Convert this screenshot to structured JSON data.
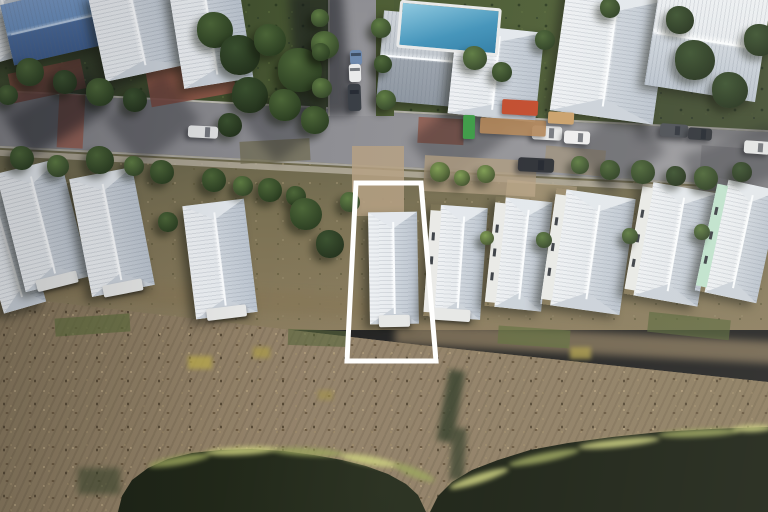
{
  "meta": {
    "image_type": "aerial-drone-photo",
    "description": "Oblique aerial photograph of a coastal neighborhood: a street with parked cars and construction items at top, a row of white metal hip-roof cottages in the middle, brown marsh grass below, dark ponds at the bottom, and a white boundary outline highlighting one lot with a house.",
    "width": 768,
    "height": 512
  },
  "palette": {
    "roof_light": "#eef1f4",
    "roof_dark": "#bac3ce",
    "ridge": "#f8fafc",
    "roof_blue_light": "#7b9cc9",
    "roof_blue_dark": "#3d5c8c",
    "asphalt": "#8e8e93",
    "sidewalk": "#b3ac9c",
    "brick": "#94584a",
    "tree_dark": "#24331d",
    "tree_light": "#7e9c52",
    "ground_green": "#45532f",
    "dirt": "#7c7254",
    "marsh": "#8d7c60",
    "water": "#20261a",
    "shore_grass": "#9aa45c",
    "shore_grass_bright": "#ccd07e",
    "pool": "#4293ba",
    "mint_wall": "#bfe2cd",
    "white_wall": "#e9eae7",
    "outline": "#ffffff",
    "dumpster": "#c14a2c",
    "porta_potty": "#3c9a46"
  },
  "highlight": {
    "name": "property-boundary-outline",
    "points": "356,183 421,183 436,361 347,361",
    "stroke": "#ffffff",
    "stroke_width": 5
  },
  "scene": {
    "houses": [
      {
        "x": -14,
        "y": 186,
        "w": 44,
        "h": 124,
        "r": -16
      },
      {
        "x": 10,
        "y": 164,
        "w": 66,
        "h": 122,
        "r": -14,
        "porch": true
      },
      {
        "x": 80,
        "y": 172,
        "w": 64,
        "h": 120,
        "r": -11,
        "porch": true
      },
      {
        "x": 189,
        "y": 202,
        "w": 62,
        "h": 114,
        "r": -7,
        "porch": true
      },
      {
        "x": 369,
        "y": 212,
        "w": 49,
        "h": 112,
        "r": -1,
        "porch": true,
        "name": "highlighted-house"
      },
      {
        "x": 427,
        "y": 206,
        "w": 57,
        "h": 112,
        "r": 4,
        "wall": "white",
        "porch": true
      },
      {
        "x": 490,
        "y": 199,
        "w": 57,
        "h": 110,
        "r": 6,
        "wall": "white"
      },
      {
        "x": 548,
        "y": 193,
        "w": 80,
        "h": 117,
        "r": 8,
        "wall": "white"
      },
      {
        "x": 633,
        "y": 186,
        "w": 75,
        "h": 115,
        "r": 10,
        "wall": "white"
      },
      {
        "x": 706,
        "y": 183,
        "w": 63,
        "h": 115,
        "r": 12,
        "wall": "mint"
      }
    ],
    "top_buildings": [
      {
        "x": -14,
        "y": -8,
        "w": 46,
        "h": 66,
        "r": -16,
        "ridge": "v"
      },
      {
        "x": 6,
        "y": -6,
        "w": 92,
        "h": 62,
        "r": -13,
        "ridge": "h",
        "roof": "blue"
      },
      {
        "x": 96,
        "y": -14,
        "w": 84,
        "h": 88,
        "r": -12,
        "ridge": "v"
      },
      {
        "x": 176,
        "y": -16,
        "w": 70,
        "h": 100,
        "r": -9,
        "ridge": "v"
      },
      {
        "x": 380,
        "y": 14,
        "w": 86,
        "h": 90,
        "r": 5,
        "ridge": "h",
        "roof": "gray"
      },
      {
        "x": 452,
        "y": 28,
        "w": 88,
        "h": 90,
        "r": 6,
        "ridge": "v"
      },
      {
        "x": 558,
        "y": -8,
        "w": 104,
        "h": 126,
        "r": 8,
        "ridge": "v"
      },
      {
        "x": 652,
        "y": -12,
        "w": 112,
        "h": 106,
        "r": 9,
        "ridge": "h"
      }
    ],
    "pool": {
      "x": 398,
      "y": 4,
      "w": 96,
      "h": 42,
      "r": 5
    },
    "cars": [
      {
        "x": 350,
        "y": 50,
        "w": 12,
        "h": 15,
        "r": -2,
        "c": "#6d89ae"
      },
      {
        "x": 349,
        "y": 64,
        "w": 12,
        "h": 18,
        "r": -2,
        "c": "#e9eaeb"
      },
      {
        "x": 348,
        "y": 84,
        "w": 13,
        "h": 27,
        "r": -2,
        "c": "#383d44"
      },
      {
        "x": 188,
        "y": 126,
        "w": 30,
        "h": 12,
        "r": 3,
        "c": "#e2e3e4"
      },
      {
        "x": 532,
        "y": 126,
        "w": 30,
        "h": 14,
        "r": 3,
        "c": "#e6e7e8"
      },
      {
        "x": 564,
        "y": 131,
        "w": 26,
        "h": 13,
        "r": 3,
        "c": "#eeeeee"
      },
      {
        "x": 518,
        "y": 158,
        "w": 36,
        "h": 14,
        "r": 3,
        "c": "#2b2e34"
      },
      {
        "x": 660,
        "y": 124,
        "w": 28,
        "h": 13,
        "r": 4,
        "c": "#4a4e54"
      },
      {
        "x": 688,
        "y": 128,
        "w": 24,
        "h": 12,
        "r": 4,
        "c": "#2f3339"
      },
      {
        "x": 744,
        "y": 141,
        "w": 26,
        "h": 13,
        "r": 4,
        "c": "#e3e4e5"
      }
    ],
    "construction": [
      {
        "x": 502,
        "y": 100,
        "w": 36,
        "h": 15,
        "r": 3,
        "c": "#c14a2c",
        "name": "red-dumpster"
      },
      {
        "x": 463,
        "y": 115,
        "w": 12,
        "h": 24,
        "r": 1,
        "c": "#3c9a46",
        "name": "porta-potty"
      },
      {
        "x": 480,
        "y": 119,
        "w": 66,
        "h": 16,
        "r": 3,
        "c": "#b08355",
        "o": 0.9,
        "name": "lumber-stack"
      },
      {
        "x": 548,
        "y": 112,
        "w": 26,
        "h": 12,
        "r": 3,
        "c": "#caa06a",
        "name": "lumber-stack"
      }
    ],
    "shadows": [
      {
        "x": 115,
        "y": 90,
        "w": 75,
        "h": 60,
        "r": -38
      },
      {
        "x": 252,
        "y": 94,
        "w": 62,
        "h": 56,
        "r": -38
      },
      {
        "x": 418,
        "y": 108,
        "w": 85,
        "h": 58,
        "r": -38
      },
      {
        "x": 582,
        "y": 118,
        "w": 72,
        "h": 62,
        "r": -38
      },
      {
        "x": 12,
        "y": 92,
        "w": 95,
        "h": 45,
        "r": -30
      },
      {
        "x": 0,
        "y": 58,
        "w": 150,
        "h": 62,
        "r": -35
      },
      {
        "x": 688,
        "y": 138,
        "w": 95,
        "h": 52,
        "r": -20
      },
      {
        "x": 636,
        "y": 25,
        "w": 140,
        "h": 115,
        "r": 0,
        "o": 0.28
      },
      {
        "x": 293,
        "y": -8,
        "w": 54,
        "h": 125,
        "r": -4,
        "o": 0.55
      }
    ],
    "patches": [
      {
        "x": 10,
        "y": 66,
        "w": 74,
        "h": 30,
        "r": -12,
        "c": "#7b493d",
        "o": 0.85
      },
      {
        "x": 148,
        "y": 64,
        "w": 86,
        "h": 36,
        "r": -10,
        "c": "#96594b",
        "o": 0.9
      },
      {
        "x": 418,
        "y": 118,
        "w": 46,
        "h": 26,
        "r": 3,
        "c": "#8e5546",
        "o": 0.8
      },
      {
        "x": 700,
        "y": 148,
        "w": 80,
        "h": 45,
        "r": 4,
        "c": "#85858a",
        "o": 1
      },
      {
        "x": 545,
        "y": 148,
        "w": 60,
        "h": 26,
        "r": 5,
        "c": "#9e8d72",
        "o": 0.6
      },
      {
        "x": 240,
        "y": 140,
        "w": 70,
        "h": 22,
        "r": -3,
        "c": "#6e6a4e",
        "o": 0.7
      }
    ],
    "marsh_details": [
      {
        "x": -10,
        "y": 286,
        "w": 430,
        "h": 22,
        "r": 3.5,
        "c": "#857656",
        "o": 0.75,
        "b": 4
      },
      {
        "x": 395,
        "y": 332,
        "w": 390,
        "h": 22,
        "r": 3,
        "c": "#8d7c60",
        "o": 0.75,
        "b": 4
      },
      {
        "x": 352,
        "y": 146,
        "w": 52,
        "h": 70,
        "r": 0,
        "c": "#b5a082",
        "o": 0.85
      },
      {
        "x": 424,
        "y": 158,
        "w": 112,
        "h": 36,
        "r": 3,
        "c": "#ad9a7e",
        "o": 0.8
      },
      {
        "x": 505,
        "y": 183,
        "w": 70,
        "h": 42,
        "r": 6,
        "c": "#bfa98a",
        "o": 0.5
      },
      {
        "x": 55,
        "y": 316,
        "w": 75,
        "h": 18,
        "r": -4,
        "c": "#5c6b3b",
        "o": 0.65
      },
      {
        "x": 288,
        "y": 330,
        "w": 62,
        "h": 16,
        "r": 2,
        "c": "#56663a",
        "o": 0.6
      },
      {
        "x": 498,
        "y": 328,
        "w": 72,
        "h": 18,
        "r": 4,
        "c": "#5f6e3c",
        "o": 0.65
      },
      {
        "x": 648,
        "y": 316,
        "w": 82,
        "h": 20,
        "r": 6,
        "c": "#566539",
        "o": 0.65
      },
      {
        "x": 188,
        "y": 356,
        "w": 24,
        "h": 13,
        "r": 0,
        "c": "#b9a94e",
        "o": 0.8,
        "b": 2
      },
      {
        "x": 253,
        "y": 347,
        "w": 17,
        "h": 11,
        "r": 0,
        "c": "#ac9c48",
        "o": 0.7,
        "b": 2
      },
      {
        "x": 570,
        "y": 347,
        "w": 21,
        "h": 12,
        "r": 0,
        "c": "#b2a24c",
        "o": 0.75,
        "b": 2
      },
      {
        "x": 318,
        "y": 390,
        "w": 15,
        "h": 10,
        "r": 0,
        "c": "#a3934a",
        "o": 0.6,
        "b": 2
      },
      {
        "x": 443,
        "y": 370,
        "w": 16,
        "h": 72,
        "r": 10,
        "c": "#2f3b27",
        "o": 0.8,
        "b": 3
      },
      {
        "x": 451,
        "y": 428,
        "w": 14,
        "h": 52,
        "r": 4,
        "c": "#2f3b27",
        "o": 0.7,
        "b": 3
      },
      {
        "x": 78,
        "y": 468,
        "w": 42,
        "h": 26,
        "r": 0,
        "c": "#39452c",
        "o": 0.6,
        "b": 3
      }
    ],
    "fringe": [
      {
        "x": 148,
        "y": 456,
        "w": 62,
        "h": 9,
        "r": -10,
        "c": "#9aa45c"
      },
      {
        "x": 205,
        "y": 447,
        "w": 72,
        "h": 8,
        "r": -3,
        "c": "#ccd07e"
      },
      {
        "x": 272,
        "y": 448,
        "w": 72,
        "h": 8,
        "r": 3,
        "c": "#9aa45c"
      },
      {
        "x": 340,
        "y": 456,
        "w": 58,
        "h": 9,
        "r": 10,
        "c": "#ccd07e"
      },
      {
        "x": 392,
        "y": 468,
        "w": 44,
        "h": 9,
        "r": 22,
        "c": "#9aa45c"
      },
      {
        "x": 448,
        "y": 474,
        "w": 62,
        "h": 9,
        "r": -18,
        "c": "#ccd07e"
      },
      {
        "x": 508,
        "y": 453,
        "w": 72,
        "h": 9,
        "r": -12,
        "c": "#9aa45c"
      },
      {
        "x": 578,
        "y": 439,
        "w": 82,
        "h": 8,
        "r": -6,
        "c": "#ccd07e"
      },
      {
        "x": 658,
        "y": 429,
        "w": 82,
        "h": 8,
        "r": -3,
        "c": "#9aa45c"
      },
      {
        "x": 732,
        "y": 425,
        "w": 40,
        "h": 7,
        "r": -2,
        "c": "#ccd07e"
      }
    ],
    "trees": [
      {
        "x": 215,
        "y": 30,
        "r": 18,
        "s": 1
      },
      {
        "x": 240,
        "y": 55,
        "r": 20,
        "s": 0
      },
      {
        "x": 270,
        "y": 40,
        "r": 16,
        "s": 1
      },
      {
        "x": 300,
        "y": 70,
        "r": 22,
        "s": 1
      },
      {
        "x": 325,
        "y": 45,
        "r": 14,
        "s": 2
      },
      {
        "x": 250,
        "y": 95,
        "r": 18,
        "s": 0
      },
      {
        "x": 285,
        "y": 105,
        "r": 16,
        "s": 1
      },
      {
        "x": 315,
        "y": 120,
        "r": 14,
        "s": 1
      },
      {
        "x": 230,
        "y": 125,
        "r": 12,
        "s": 0
      },
      {
        "x": 320,
        "y": 18,
        "r": 9,
        "s": 2
      },
      {
        "x": 321,
        "y": 52,
        "r": 9,
        "s": 1
      },
      {
        "x": 322,
        "y": 88,
        "r": 10,
        "s": 2
      },
      {
        "x": 381,
        "y": 28,
        "r": 10,
        "s": 2
      },
      {
        "x": 383,
        "y": 64,
        "r": 9,
        "s": 1
      },
      {
        "x": 386,
        "y": 100,
        "r": 10,
        "s": 2
      },
      {
        "x": 30,
        "y": 72,
        "r": 14,
        "s": 1
      },
      {
        "x": 65,
        "y": 82,
        "r": 12,
        "s": 0
      },
      {
        "x": 100,
        "y": 92,
        "r": 14,
        "s": 1
      },
      {
        "x": 135,
        "y": 100,
        "r": 12,
        "s": 0
      },
      {
        "x": 8,
        "y": 95,
        "r": 10,
        "s": 1
      },
      {
        "x": 475,
        "y": 58,
        "r": 12,
        "s": 2
      },
      {
        "x": 502,
        "y": 72,
        "r": 10,
        "s": 1
      },
      {
        "x": 545,
        "y": 40,
        "r": 10,
        "s": 1
      },
      {
        "x": 610,
        "y": 8,
        "r": 10,
        "s": 1
      },
      {
        "x": 695,
        "y": 60,
        "r": 20,
        "s": 0
      },
      {
        "x": 730,
        "y": 90,
        "r": 18,
        "s": 0
      },
      {
        "x": 760,
        "y": 40,
        "r": 16,
        "s": 0
      },
      {
        "x": 680,
        "y": 20,
        "r": 14,
        "s": 0
      },
      {
        "x": 22,
        "y": 158,
        "r": 12,
        "s": 1
      },
      {
        "x": 58,
        "y": 166,
        "r": 11,
        "s": 2
      },
      {
        "x": 100,
        "y": 160,
        "r": 14,
        "s": 1
      },
      {
        "x": 134,
        "y": 166,
        "r": 10,
        "s": 2
      },
      {
        "x": 162,
        "y": 172,
        "r": 12,
        "s": 1
      },
      {
        "x": 214,
        "y": 180,
        "r": 12,
        "s": 1
      },
      {
        "x": 243,
        "y": 186,
        "r": 10,
        "s": 2
      },
      {
        "x": 270,
        "y": 190,
        "r": 12,
        "s": 1
      },
      {
        "x": 296,
        "y": 196,
        "r": 10,
        "s": 1
      },
      {
        "x": 306,
        "y": 214,
        "r": 16,
        "s": 1
      },
      {
        "x": 330,
        "y": 244,
        "r": 14,
        "s": 0
      },
      {
        "x": 350,
        "y": 202,
        "r": 10,
        "s": 2
      },
      {
        "x": 168,
        "y": 222,
        "r": 10,
        "s": 1
      },
      {
        "x": 440,
        "y": 172,
        "r": 10,
        "s": 3
      },
      {
        "x": 462,
        "y": 178,
        "r": 8,
        "s": 3
      },
      {
        "x": 486,
        "y": 174,
        "r": 9,
        "s": 3
      },
      {
        "x": 580,
        "y": 165,
        "r": 9,
        "s": 2
      },
      {
        "x": 610,
        "y": 170,
        "r": 10,
        "s": 1
      },
      {
        "x": 643,
        "y": 172,
        "r": 12,
        "s": 1
      },
      {
        "x": 676,
        "y": 176,
        "r": 10,
        "s": 0
      },
      {
        "x": 706,
        "y": 178,
        "r": 12,
        "s": 1
      },
      {
        "x": 742,
        "y": 172,
        "r": 10,
        "s": 0
      },
      {
        "x": 487,
        "y": 238,
        "r": 7,
        "s": 3
      },
      {
        "x": 544,
        "y": 240,
        "r": 8,
        "s": 2
      },
      {
        "x": 630,
        "y": 236,
        "r": 8,
        "s": 2
      },
      {
        "x": 702,
        "y": 232,
        "r": 8,
        "s": 2
      }
    ]
  }
}
